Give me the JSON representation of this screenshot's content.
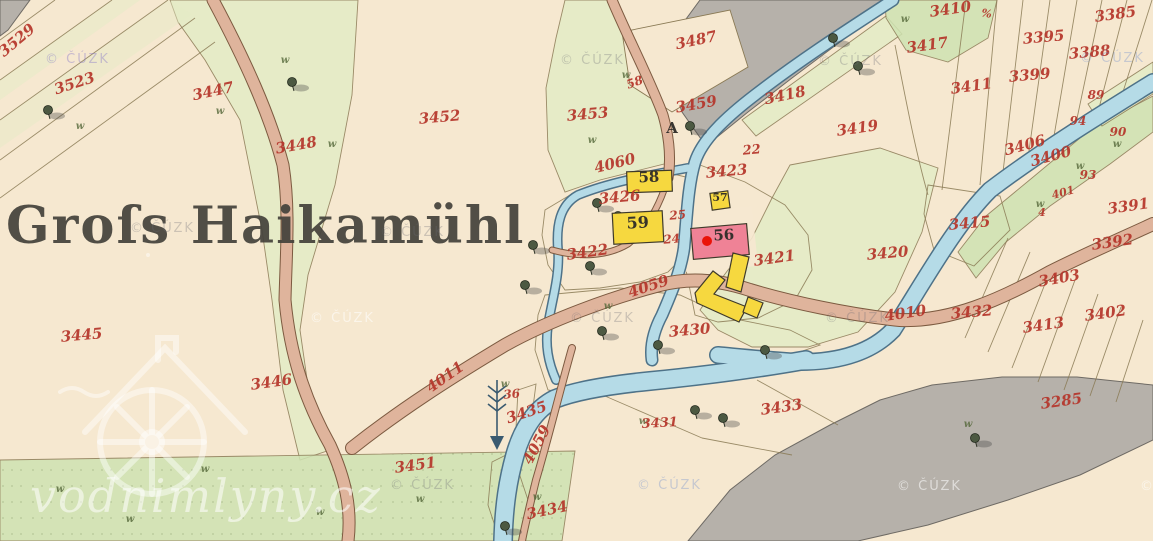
{
  "map": {
    "place_label": "Groſs Haikamühl",
    "colors": {
      "paper": "#f6e8d0",
      "pale_green": "#e4ecc6",
      "meadow": "#cfe3b2",
      "garden": "#92c9a2",
      "garden_bright": "#7cc894",
      "hatch": "#2f6e54",
      "water": "#b5dbe7",
      "water_edge": "#4e7288",
      "road": "#dfb49c",
      "road_edge": "#7c5a40",
      "rock": "#b6b1aa",
      "building_wood": "#f6d83f",
      "building_masonry": "#ef8296",
      "building_edge": "#3f3a2a",
      "marker_red": "#ea1308",
      "label_red": "#b5352a",
      "label_black": "#2e2c28",
      "boundary": "#8a7a55"
    },
    "parcel_labels": [
      {
        "t": "3529",
        "x": 20,
        "y": 44,
        "r": -40
      },
      {
        "t": "3523",
        "x": 76,
        "y": 88,
        "r": -18
      },
      {
        "t": "3447",
        "x": 214,
        "y": 96,
        "r": -12
      },
      {
        "t": "3448",
        "x": 297,
        "y": 150,
        "r": -10
      },
      {
        "t": "3452",
        "x": 440,
        "y": 122,
        "r": -5
      },
      {
        "t": "3453",
        "x": 588,
        "y": 119,
        "r": -5
      },
      {
        "t": "3487",
        "x": 697,
        "y": 45,
        "r": -12
      },
      {
        "t": "3459",
        "x": 697,
        "y": 109,
        "r": -10
      },
      {
        "t": "3418",
        "x": 786,
        "y": 100,
        "r": -12
      },
      {
        "t": "3419",
        "x": 858,
        "y": 133,
        "r": -8
      },
      {
        "t": "22",
        "x": 752,
        "y": 154,
        "r": -5,
        "s": 13
      },
      {
        "t": "3423",
        "x": 727,
        "y": 176,
        "r": -5
      },
      {
        "t": "3426",
        "x": 620,
        "y": 202,
        "r": -5
      },
      {
        "t": "25",
        "x": 678,
        "y": 219,
        "r": -5,
        "s": 12
      },
      {
        "t": "24",
        "x": 672,
        "y": 243,
        "r": -5,
        "s": 12
      },
      {
        "t": "3422",
        "x": 588,
        "y": 257,
        "r": -8
      },
      {
        "t": "3421",
        "x": 775,
        "y": 263,
        "r": -8
      },
      {
        "t": "3420",
        "x": 888,
        "y": 258,
        "r": -5
      },
      {
        "t": "3415",
        "x": 970,
        "y": 228,
        "r": -5
      },
      {
        "t": "4060",
        "x": 616,
        "y": 168,
        "r": -14
      },
      {
        "t": "4059",
        "x": 650,
        "y": 291,
        "r": -18
      },
      {
        "t": "4059",
        "x": 541,
        "y": 447,
        "r": -62
      },
      {
        "t": "4011",
        "x": 448,
        "y": 381,
        "r": -35
      },
      {
        "t": "4010",
        "x": 906,
        "y": 318,
        "r": -8
      },
      {
        "t": "3430",
        "x": 690,
        "y": 335,
        "r": -5
      },
      {
        "t": "3432",
        "x": 972,
        "y": 317,
        "r": -5
      },
      {
        "t": "3433",
        "x": 782,
        "y": 412,
        "r": -8
      },
      {
        "t": "3431",
        "x": 660,
        "y": 427,
        "r": -3,
        "s": 13
      },
      {
        "t": "36",
        "x": 512,
        "y": 398,
        "r": -5,
        "s": 12
      },
      {
        "t": "3435",
        "x": 528,
        "y": 417,
        "r": -18
      },
      {
        "t": "3434",
        "x": 548,
        "y": 515,
        "r": -12
      },
      {
        "t": "3451",
        "x": 416,
        "y": 470,
        "r": -8
      },
      {
        "t": "3445",
        "x": 82,
        "y": 340,
        "r": -5
      },
      {
        "t": "3446",
        "x": 272,
        "y": 387,
        "r": -8
      },
      {
        "t": "3285",
        "x": 1062,
        "y": 406,
        "r": -8
      },
      {
        "t": "3410",
        "x": 951,
        "y": 14,
        "r": -8
      },
      {
        "t": "3417",
        "x": 928,
        "y": 50,
        "r": -8
      },
      {
        "t": "3395",
        "x": 1044,
        "y": 42,
        "r": -5
      },
      {
        "t": "3385",
        "x": 1116,
        "y": 19,
        "r": -8
      },
      {
        "t": "3388",
        "x": 1090,
        "y": 57,
        "r": -5
      },
      {
        "t": "3399",
        "x": 1030,
        "y": 80,
        "r": -5
      },
      {
        "t": "3411",
        "x": 972,
        "y": 91,
        "r": -8
      },
      {
        "t": "89",
        "x": 1096,
        "y": 99,
        "r": 0,
        "s": 12
      },
      {
        "t": "94",
        "x": 1078,
        "y": 125,
        "r": 0,
        "s": 12
      },
      {
        "t": "90",
        "x": 1118,
        "y": 136,
        "r": 0,
        "s": 12
      },
      {
        "t": "3406",
        "x": 1026,
        "y": 150,
        "r": -15
      },
      {
        "t": "3400",
        "x": 1052,
        "y": 161,
        "r": -15
      },
      {
        "t": "93",
        "x": 1088,
        "y": 179,
        "r": 0,
        "s": 12
      },
      {
        "t": "401",
        "x": 1064,
        "y": 196,
        "r": -15,
        "s": 11
      },
      {
        "t": "4",
        "x": 1042,
        "y": 216,
        "r": 0,
        "s": 11
      },
      {
        "t": "3391",
        "x": 1129,
        "y": 211,
        "r": -8
      },
      {
        "t": "3392",
        "x": 1113,
        "y": 247,
        "r": -8
      },
      {
        "t": "3403",
        "x": 1060,
        "y": 283,
        "r": -10
      },
      {
        "t": "3413",
        "x": 1044,
        "y": 330,
        "r": -8
      },
      {
        "t": "3402",
        "x": 1106,
        "y": 318,
        "r": -8
      },
      {
        "t": "58",
        "x": 636,
        "y": 86,
        "r": -20,
        "s": 12
      },
      {
        "t": "%",
        "x": 986,
        "y": 17,
        "r": 10,
        "s": 11
      },
      {
        "t": "58",
        "x": 649,
        "y": 182,
        "r": -2,
        "s": 15,
        "c": "black"
      },
      {
        "t": "59",
        "x": 638,
        "y": 228,
        "r": -3,
        "s": 16,
        "c": "black"
      },
      {
        "t": "57",
        "x": 720,
        "y": 201,
        "r": 0,
        "s": 11,
        "c": "black"
      },
      {
        "t": "56",
        "x": 724,
        "y": 240,
        "r": -3,
        "s": 15,
        "c": "black"
      },
      {
        "t": "A",
        "x": 672,
        "y": 133,
        "r": 0,
        "s": 15,
        "c": "black"
      }
    ],
    "buildings": [
      {
        "label": "58",
        "shape": "rect",
        "x": 627,
        "y": 171,
        "w": 45,
        "h": 21,
        "rot": -2,
        "type": "wood"
      },
      {
        "label": "59",
        "shape": "rect",
        "x": 613,
        "y": 212,
        "w": 50,
        "h": 31,
        "rot": -3,
        "type": "wood"
      },
      {
        "label": "57",
        "shape": "rect",
        "x": 711,
        "y": 192,
        "w": 18,
        "h": 17,
        "rot": -8,
        "type": "wood"
      },
      {
        "label": "56",
        "shape": "rect",
        "x": 692,
        "y": 226,
        "w": 56,
        "h": 31,
        "rot": -5,
        "type": "masonry"
      },
      {
        "shape": "poly",
        "points": "733,253 749,257 741,292 726,287",
        "type": "wood"
      },
      {
        "shape": "poly",
        "points": "695,293 713,271 725,280 714,294 747,307 739,322 697,303",
        "type": "wood"
      },
      {
        "shape": "poly",
        "points": "748,297 763,303 757,318 743,312",
        "type": "wood"
      }
    ],
    "mill_marker": {
      "x": 707,
      "y": 241
    },
    "trees": [
      [
        48,
        112
      ],
      [
        292,
        84
      ],
      [
        597,
        205
      ],
      [
        590,
        268
      ],
      [
        533,
        247
      ],
      [
        525,
        287
      ],
      [
        602,
        333
      ],
      [
        658,
        347
      ],
      [
        695,
        412
      ],
      [
        833,
        40
      ],
      [
        858,
        68
      ],
      [
        975,
        440
      ],
      [
        690,
        128
      ],
      [
        765,
        352
      ],
      [
        618,
        218
      ],
      [
        723,
        420
      ],
      [
        505,
        528
      ]
    ],
    "grass_marks": [
      [
        285,
        63
      ],
      [
        220,
        114
      ],
      [
        332,
        147
      ],
      [
        80,
        129
      ],
      [
        592,
        143
      ],
      [
        626,
        78
      ],
      [
        608,
        309
      ],
      [
        505,
        387
      ],
      [
        643,
        424
      ],
      [
        537,
        500
      ],
      [
        905,
        22
      ],
      [
        1117,
        147
      ],
      [
        1040,
        207
      ],
      [
        1080,
        169
      ],
      [
        968,
        427
      ],
      [
        60,
        492
      ],
      [
        205,
        472
      ],
      [
        420,
        502
      ],
      [
        130,
        522
      ],
      [
        320,
        515
      ]
    ]
  },
  "watermarks": {
    "site": "vodnimlyny.cz",
    "copyright": "© ČÚZK",
    "tint_colors": {
      "purple": "rgba(130,115,200,0.40)",
      "gray": "rgba(105,105,115,0.30)",
      "blue": "rgba(110,140,205,0.35)",
      "light": "rgba(255,255,255,0.55)"
    },
    "copyright_positions": [
      [
        45,
        63,
        "purple"
      ],
      [
        130,
        232,
        "gray"
      ],
      [
        380,
        236,
        "gray"
      ],
      [
        560,
        64,
        "gray"
      ],
      [
        818,
        65,
        "gray"
      ],
      [
        1080,
        62,
        "blue"
      ],
      [
        570,
        322,
        "gray"
      ],
      [
        825,
        322,
        "gray"
      ],
      [
        310,
        322,
        "light"
      ],
      [
        390,
        489,
        "gray"
      ],
      [
        637,
        489,
        "blue"
      ],
      [
        897,
        490,
        "light"
      ],
      [
        1140,
        490,
        "light"
      ]
    ]
  }
}
